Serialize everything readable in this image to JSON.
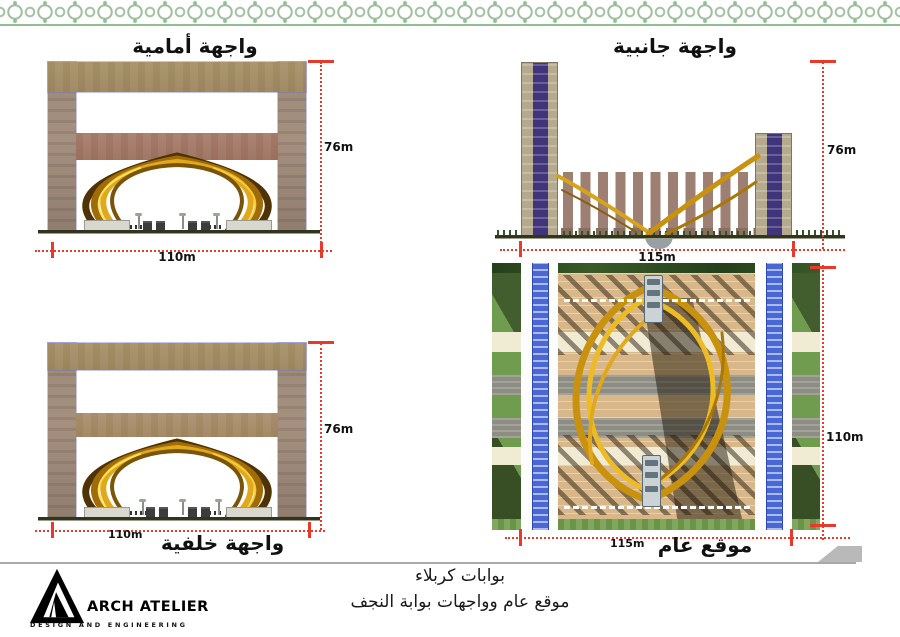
{
  "views": {
    "front": {
      "title": "واجهة أمامية",
      "height": "76m",
      "width": "110m"
    },
    "side": {
      "title": "واجهة جانبية",
      "height": "76m",
      "width": "115m"
    },
    "back": {
      "title": "واجهة خلفية",
      "height": "76m",
      "width": "110m"
    },
    "site": {
      "title": "موقع عام",
      "height": "110m",
      "width": "115m"
    }
  },
  "footer": {
    "project_title": "بوابات كربلاء",
    "sheet_subtitle": "موقع عام وواجهات بوابة النجف"
  },
  "logo": {
    "name": "ARCH ATELIER",
    "tagline": "DESIGN AND ENGINEERING"
  },
  "colors": {
    "dimension_red": "#e8392b",
    "gold": "#d7a31a",
    "stone_tan": "#a5916e",
    "tile_blue": "#4a67d6",
    "ornament_green": "#93bd92"
  }
}
